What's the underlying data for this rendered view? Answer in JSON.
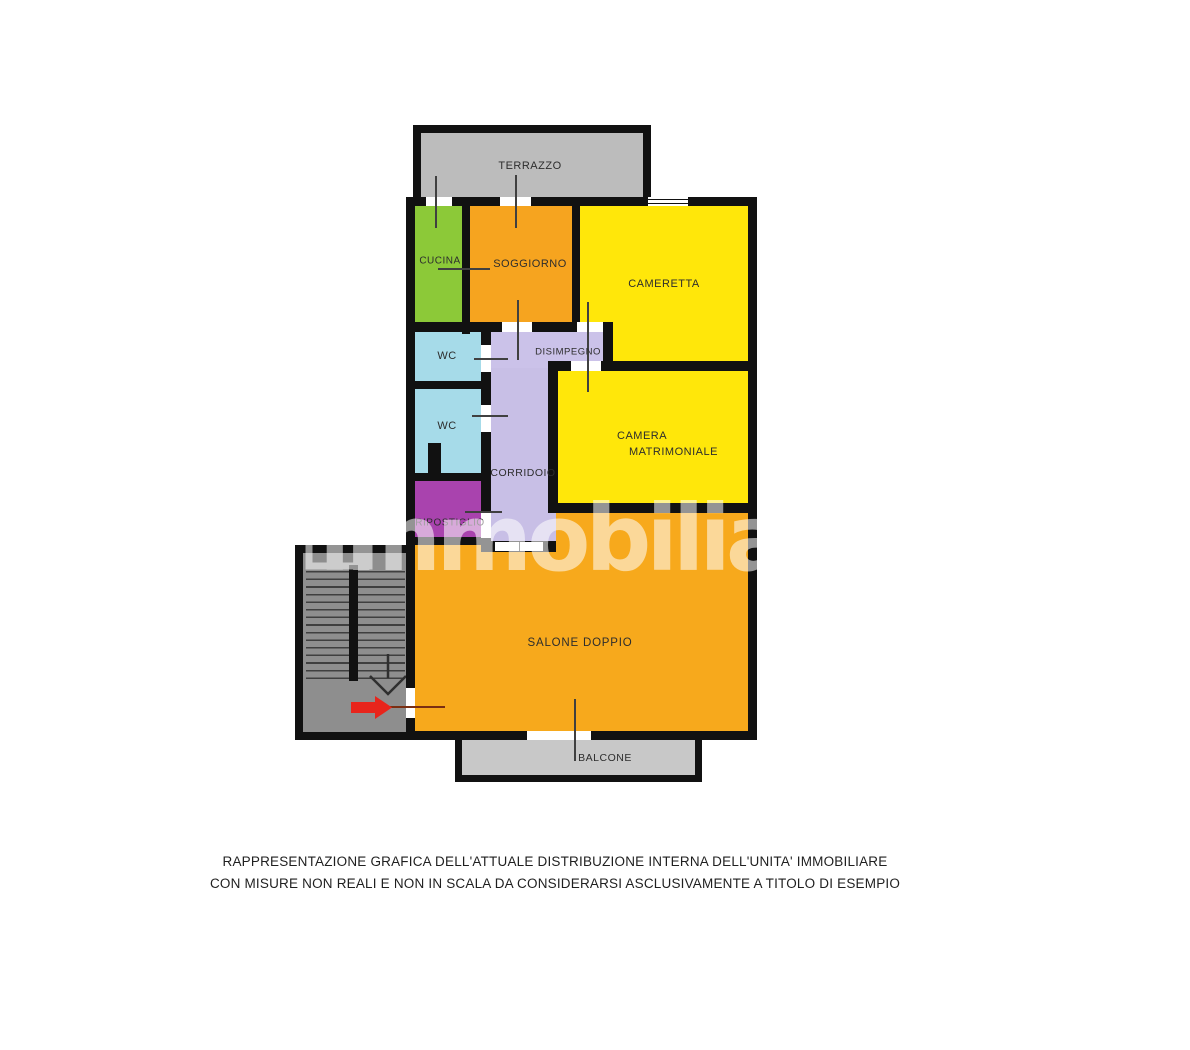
{
  "plan": {
    "wall_color": "#111111",
    "opening_color": "#ffffff",
    "door_line_color": "#404040",
    "entrance_line_color": "#7a2e12",
    "label_color": "#2d2d2d"
  },
  "rooms": {
    "terrazzo": {
      "label": "TERRAZZO",
      "color": "#bcbcbc"
    },
    "cucina": {
      "label": "CUCINA",
      "color": "#8cc938"
    },
    "soggiorno": {
      "label": "SOGGIORNO",
      "color": "#f6a41f"
    },
    "cameretta": {
      "label": "CAMERETTA",
      "color": "#ffe70a"
    },
    "wc1": {
      "label": "WC",
      "color": "#a6dbe9"
    },
    "wc2": {
      "label": "WC",
      "color": "#a6dbe9"
    },
    "disimpegno": {
      "label": "DISIMPEGNO",
      "color": "#cbc2e9"
    },
    "corridoio": {
      "label": "CORRIDOIO",
      "color": "#c8bfe6"
    },
    "ripostiglio": {
      "label": "RIPOSTIGLIO",
      "color": "#a943ae"
    },
    "camera_matrimoniale": {
      "label_line1": "CAMERA",
      "label_line2": "MATRIMONIALE",
      "color": "#ffe70a"
    },
    "salone": {
      "label": "SALONE DOPPIO",
      "color": "#f7a91c"
    },
    "balcone": {
      "label": "BALCONE",
      "color": "#c8c8c8"
    }
  },
  "stairs": {
    "fill": "#8e8e8e",
    "arrow_color": "#e8251c"
  },
  "watermark": {
    "text": "immobiliare.it",
    "icon": "house-icon"
  },
  "disclaimer": {
    "color": "#1f1f1f",
    "line1": "RAPPRESENTAZIONE GRAFICA DELL'ATTUALE DISTRIBUZIONE INTERNA DELL'UNITA' IMMOBILIARE",
    "line2": "CON MISURE NON REALI E NON IN SCALA DA CONSIDERARSI ASCLUSIVAMENTE A TITOLO DI ESEMPIO"
  }
}
